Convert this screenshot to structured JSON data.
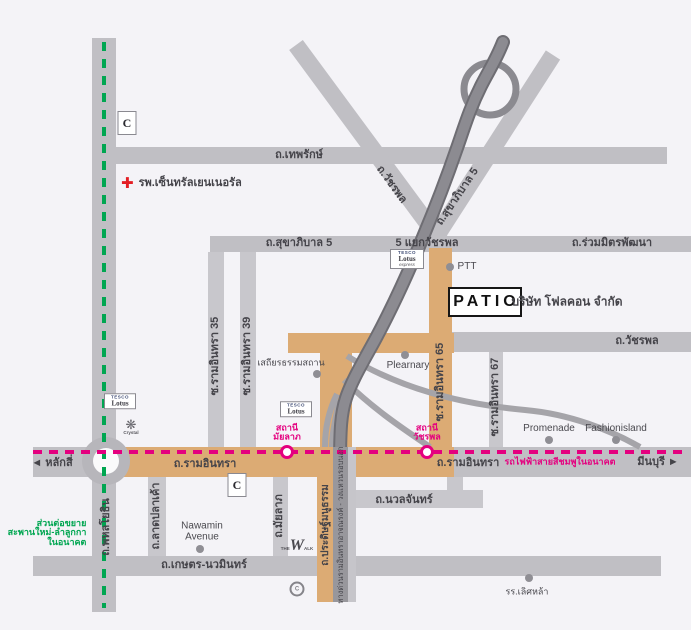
{
  "colors": {
    "background": "#f4f3f7",
    "road_gray": "#c0bfc4",
    "road_minor": "#c8c7cc",
    "expressway_dark": "#6e6d73",
    "route_orange": "#dcab74",
    "pink_line": "#e4007f",
    "green_line": "#00a651",
    "hospital_red": "#e31e24",
    "label_text": "#45444a"
  },
  "roads": {
    "theprak": "ถ.เทพรักษ์",
    "watcharaphon_diag": "ถ.วัชรพล",
    "sukhaphiban5_diag": "ถ.สุขาภิบาล 5",
    "sukhaphiban5": "ถ.สุขาภิบาล 5",
    "yaek_watcharaphon": "5 แยกวัชรพล",
    "ruammit_phatthana": "ถ.ร่วมมิตรพัฒนา",
    "soi_raminthra_35": "ซ.รามอินทรา 35",
    "soi_raminthra_39": "ซ.รามอินทรา 39",
    "soi_raminthra_65": "ซ.รามอินทรา 65",
    "soi_raminthra_67": "ซ.รามอินทรา 67",
    "watcharaphon": "ถ.วัชรพล",
    "raminthra_west": "ถ.รามอินทรา",
    "raminthra_east": "ถ.รามอินทรา",
    "laksi": "◄ หลักสี่",
    "minburi": "มีนบุรี ►",
    "phahonyothin": "ถ.พหลโยธิน",
    "lat_pla_khao": "ถ.ลาดปลาเค้า",
    "mayalap": "ถ.มัยลาภ",
    "pradit_manutham": "ถ.ประดิษฐ์มนูธรรม",
    "expressway": "ทางด่วนรามอินทราอาจณรงค์ - วงแหวนรอบนอก",
    "kaset_nawamin": "ถ.เกษตร-นวมินทร์",
    "nuanchan": "ถ.นวลจันทร์"
  },
  "transit": {
    "pink_line_note": "รถไฟฟ้าสายสีชมพูในอนาคต",
    "green_ext_line1": "ส่วนต่อขยาย",
    "green_ext_line2": "สะพานใหม่-ลำลูกกา",
    "green_ext_line3": "ในอนาคต",
    "station_mayalap_line1": "สถานี",
    "station_mayalap_line2": "มัยลาภ",
    "station_watcharaphon_line1": "สถานี",
    "station_watcharaphon_line2": "วัชรพล"
  },
  "places": {
    "hospital": "รพ.เซ็นทรัลเยนเนอรัล",
    "ptt": "PTT",
    "patio": "PATIO",
    "company": "บริษัท โฟลคอน จำกัด",
    "sathira": "เสถียรธรรมสถาน",
    "plearnary": "Plearnary",
    "promenade": "Promenade",
    "fashionisland": "Fashionisland",
    "nawamin_avenue_line1": "Nawamin",
    "nawamin_avenue_line2": "Avenue",
    "lertlah_school": "รร.เลิศหล้า"
  },
  "logos": {
    "tesco_line1": "TESCO",
    "tesco_line2": "Lotus",
    "tesco_express": "express",
    "central": "C",
    "crystal_snow": "❋",
    "crystal": "Crystal",
    "walk_the": "THE",
    "walk_w": "W",
    "walk_alk": "ALK",
    "c_ring": "C",
    "hospital_cross": "✚"
  }
}
